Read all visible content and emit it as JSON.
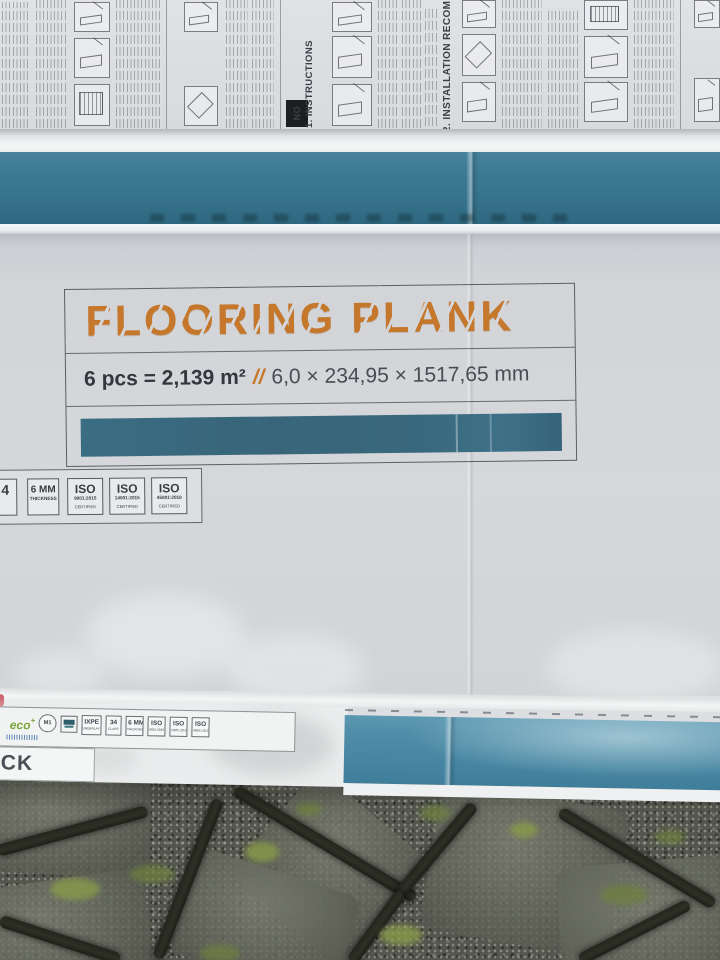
{
  "colors": {
    "teal_band": "#3c7a93",
    "teal_bar": "#39697e",
    "teal_bottom": "#4f8da8",
    "orange": "#c5772c",
    "ink": "#3b4046",
    "cardboard": "#d2d4d8",
    "moss": "#6f8040"
  },
  "top_print": {
    "no_label": "NO",
    "section1": "1. INSTRUCTIONS",
    "section2": "2. INSTALLATION RECOMMEN"
  },
  "panel": {
    "title": "FLOORING PLANK",
    "pieces": "6 pcs = 2,139 m²",
    "separator": "//",
    "dimensions": "6,0 × 234,95 × 1517,65 mm"
  },
  "upper_badges": [
    {
      "label": "4",
      "sub": "",
      "sub2": ""
    },
    {
      "label": "6 MM",
      "sub": "THICKNESS",
      "sub2": ""
    },
    {
      "label": "ISO",
      "sub": "9001:2015",
      "sub2": "CERTIFIED"
    },
    {
      "label": "ISO",
      "sub": "14001:2015",
      "sub2": "CERTIFIED"
    },
    {
      "label": "ISO",
      "sub": "45001:2018",
      "sub2": "CERTIFIED"
    }
  ],
  "lower_badges": {
    "eco": "eco",
    "eco_plus": "+",
    "m1": "M1",
    "ixpe": "IXPE",
    "ixpe_sub": "UNDERLAY",
    "class34": "34",
    "class34_sub": "CLASS",
    "mm6": "6 MM",
    "mm6_sub": "THICKNESS",
    "iso1": "ISO",
    "iso1_sub": "9001:2015",
    "iso2": "ISO",
    "iso2_sub": "14001:2015",
    "iso3": "ISO",
    "iso3_sub": "45001:2018"
  },
  "bottom_left": {
    "partial_text": "CK"
  }
}
